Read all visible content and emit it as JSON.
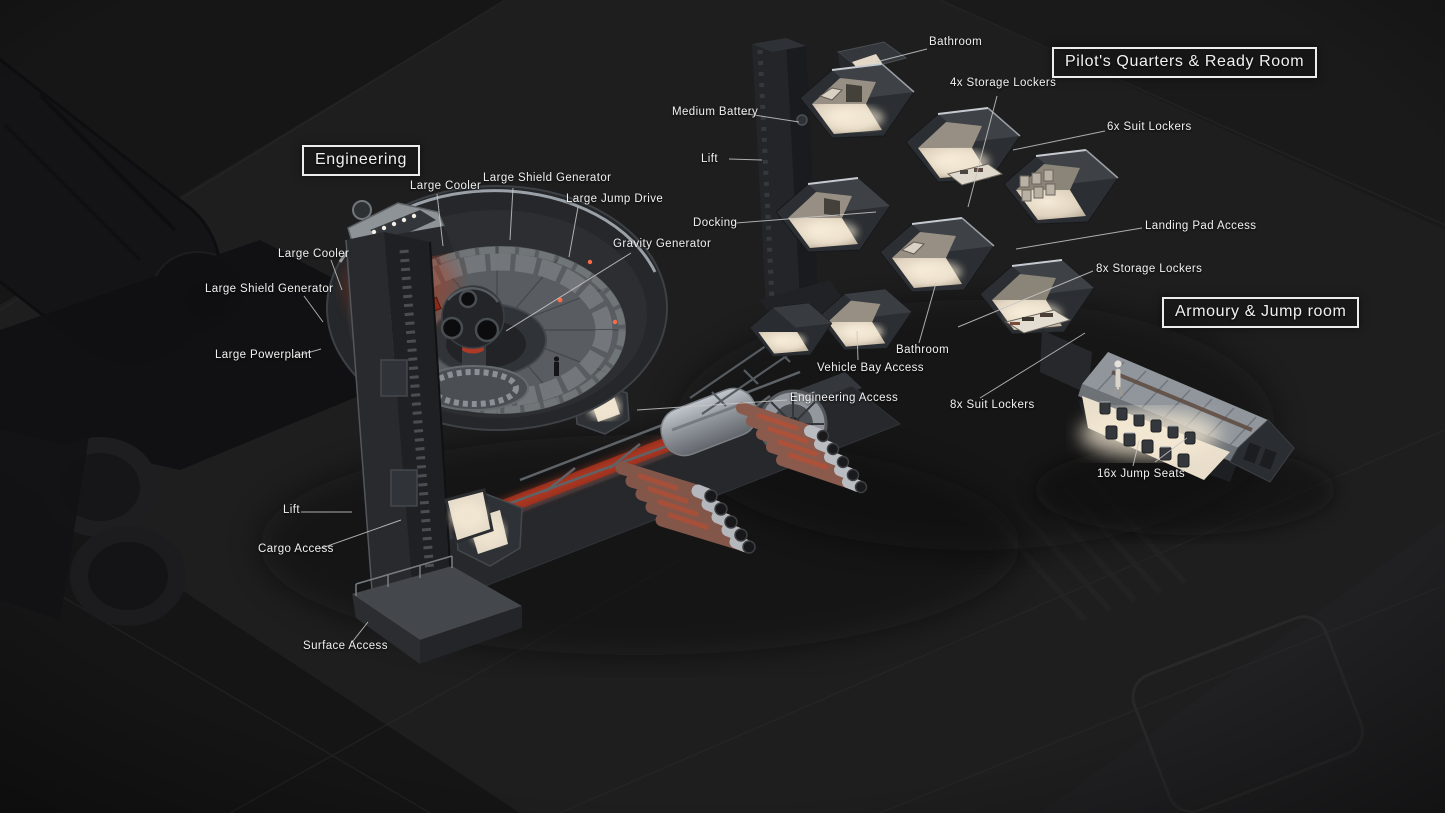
{
  "section_titles": [
    {
      "id": "engineering",
      "label": "Engineering"
    },
    {
      "id": "pilots-quarters",
      "label": "Pilot's Quarters & Ready Room"
    },
    {
      "id": "armoury-jump-room",
      "label": "Armoury & Jump room"
    }
  ],
  "labels": [
    {
      "id": "bathroom-top",
      "text": "Bathroom"
    },
    {
      "id": "storage-lockers-4x",
      "text": "4x Storage Lockers"
    },
    {
      "id": "suit-lockers-6x",
      "text": "6x Suit Lockers"
    },
    {
      "id": "medium-battery",
      "text": "Medium Battery"
    },
    {
      "id": "lift-upper",
      "text": "Lift"
    },
    {
      "id": "docking",
      "text": "Docking"
    },
    {
      "id": "landing-pad-access",
      "text": "Landing Pad Access"
    },
    {
      "id": "storage-lockers-8x",
      "text": "8x Storage Lockers"
    },
    {
      "id": "bathroom-lower",
      "text": "Bathroom"
    },
    {
      "id": "vehicle-bay-access",
      "text": "Vehicle Bay Access"
    },
    {
      "id": "engineering-access",
      "text": "Engineering Access"
    },
    {
      "id": "suit-lockers-8x",
      "text": "8x Suit Lockers"
    },
    {
      "id": "jump-seats-16x",
      "text": "16x Jump Seats"
    },
    {
      "id": "large-cooler-top",
      "text": "Large Cooler"
    },
    {
      "id": "large-shield-generator-top",
      "text": "Large Shield Generator"
    },
    {
      "id": "large-jump-drive",
      "text": "Large Jump Drive"
    },
    {
      "id": "gravity-generator",
      "text": "Gravity Generator"
    },
    {
      "id": "large-cooler-left",
      "text": "Large Cooler"
    },
    {
      "id": "large-shield-generator-left",
      "text": "Large Shield Generator"
    },
    {
      "id": "large-powerplant",
      "text": "Large Powerplant"
    },
    {
      "id": "lift-lower",
      "text": "Lift"
    },
    {
      "id": "cargo-access",
      "text": "Cargo Access"
    },
    {
      "id": "surface-access",
      "text": "Surface Access"
    }
  ],
  "colors": {
    "bg": "#1c1c1d",
    "label-text": "#f1f1f1",
    "leader-line": "#c7c7c7",
    "title-border": "#ededed",
    "glow-red": "#c23a22",
    "interior-warm": "#eadfcb",
    "hull-dark": "#2b2e32",
    "metal-light": "#b9bec4"
  }
}
